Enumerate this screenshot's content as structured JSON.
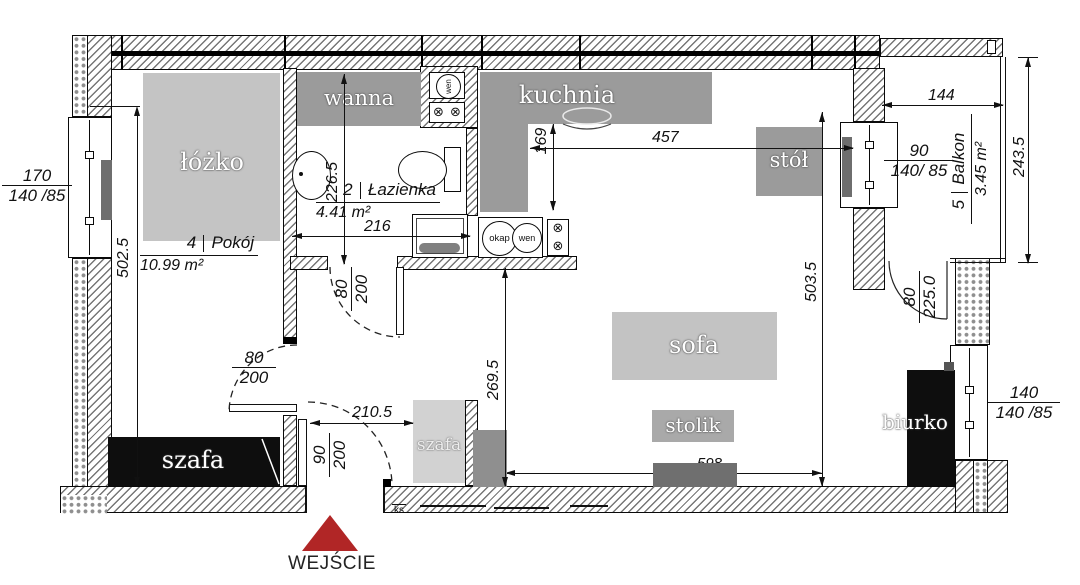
{
  "rooms": {
    "bedroom": {
      "number": "4",
      "name": "Pokój",
      "area": "10.99 m²"
    },
    "bathroom": {
      "number": "2",
      "name": "Łazienka",
      "area": "4.41 m²"
    },
    "balcony": {
      "number": "5",
      "name": "Balkon",
      "area": "3.45 m²"
    }
  },
  "furniture": {
    "bed": "łóżko",
    "bathtub": "wanna",
    "kitchen": "kuchnia",
    "table": "stół",
    "sofa": "sofa",
    "coffee_table": "stolik",
    "desk": "biurko",
    "wardrobe_bedroom": "szafa",
    "wardrobe_hall": "szafa"
  },
  "fixtures": {
    "hood": "okap",
    "vent": "wen",
    "ks": "ks"
  },
  "dims": {
    "d170": {
      "num": "170",
      "den": "140 /85"
    },
    "d90w": {
      "num": "90",
      "den": "140/ 85"
    },
    "d140w": {
      "num": "140",
      "den": "140 /85"
    },
    "d5025": "502.5",
    "d2265": "226.5",
    "d216": "216",
    "d169": "169",
    "d457": "457",
    "d144": "144",
    "d2435": "243.5",
    "d5035": "503.5",
    "d2695": "269.5",
    "d2105": "210.5",
    "d598": "598",
    "door_bed": {
      "num": "80",
      "den": "200"
    },
    "door_bath": {
      "num": "80",
      "den": "200"
    },
    "door_entry": {
      "num": "90",
      "den": "200"
    },
    "door_balcony": {
      "num": "80",
      "den": "225.0"
    }
  },
  "labels": {
    "entrance": "WEJŚCIE"
  },
  "colors": {
    "entrance_red": "#b12626",
    "counter_gray": "#9b9b9b",
    "bed_gray": "#c4c4c4",
    "sofa_gray": "#c3c3c3",
    "stolik_gray": "#a9a9a9",
    "tv_gray": "#6f6f6f",
    "furniture_black": "#0e0e0e",
    "hall_wardrobe_gray": "#d2d2d2",
    "hall_cabinet_gray": "#8f8f8f",
    "radiator_gray": "#6e6e6e"
  }
}
